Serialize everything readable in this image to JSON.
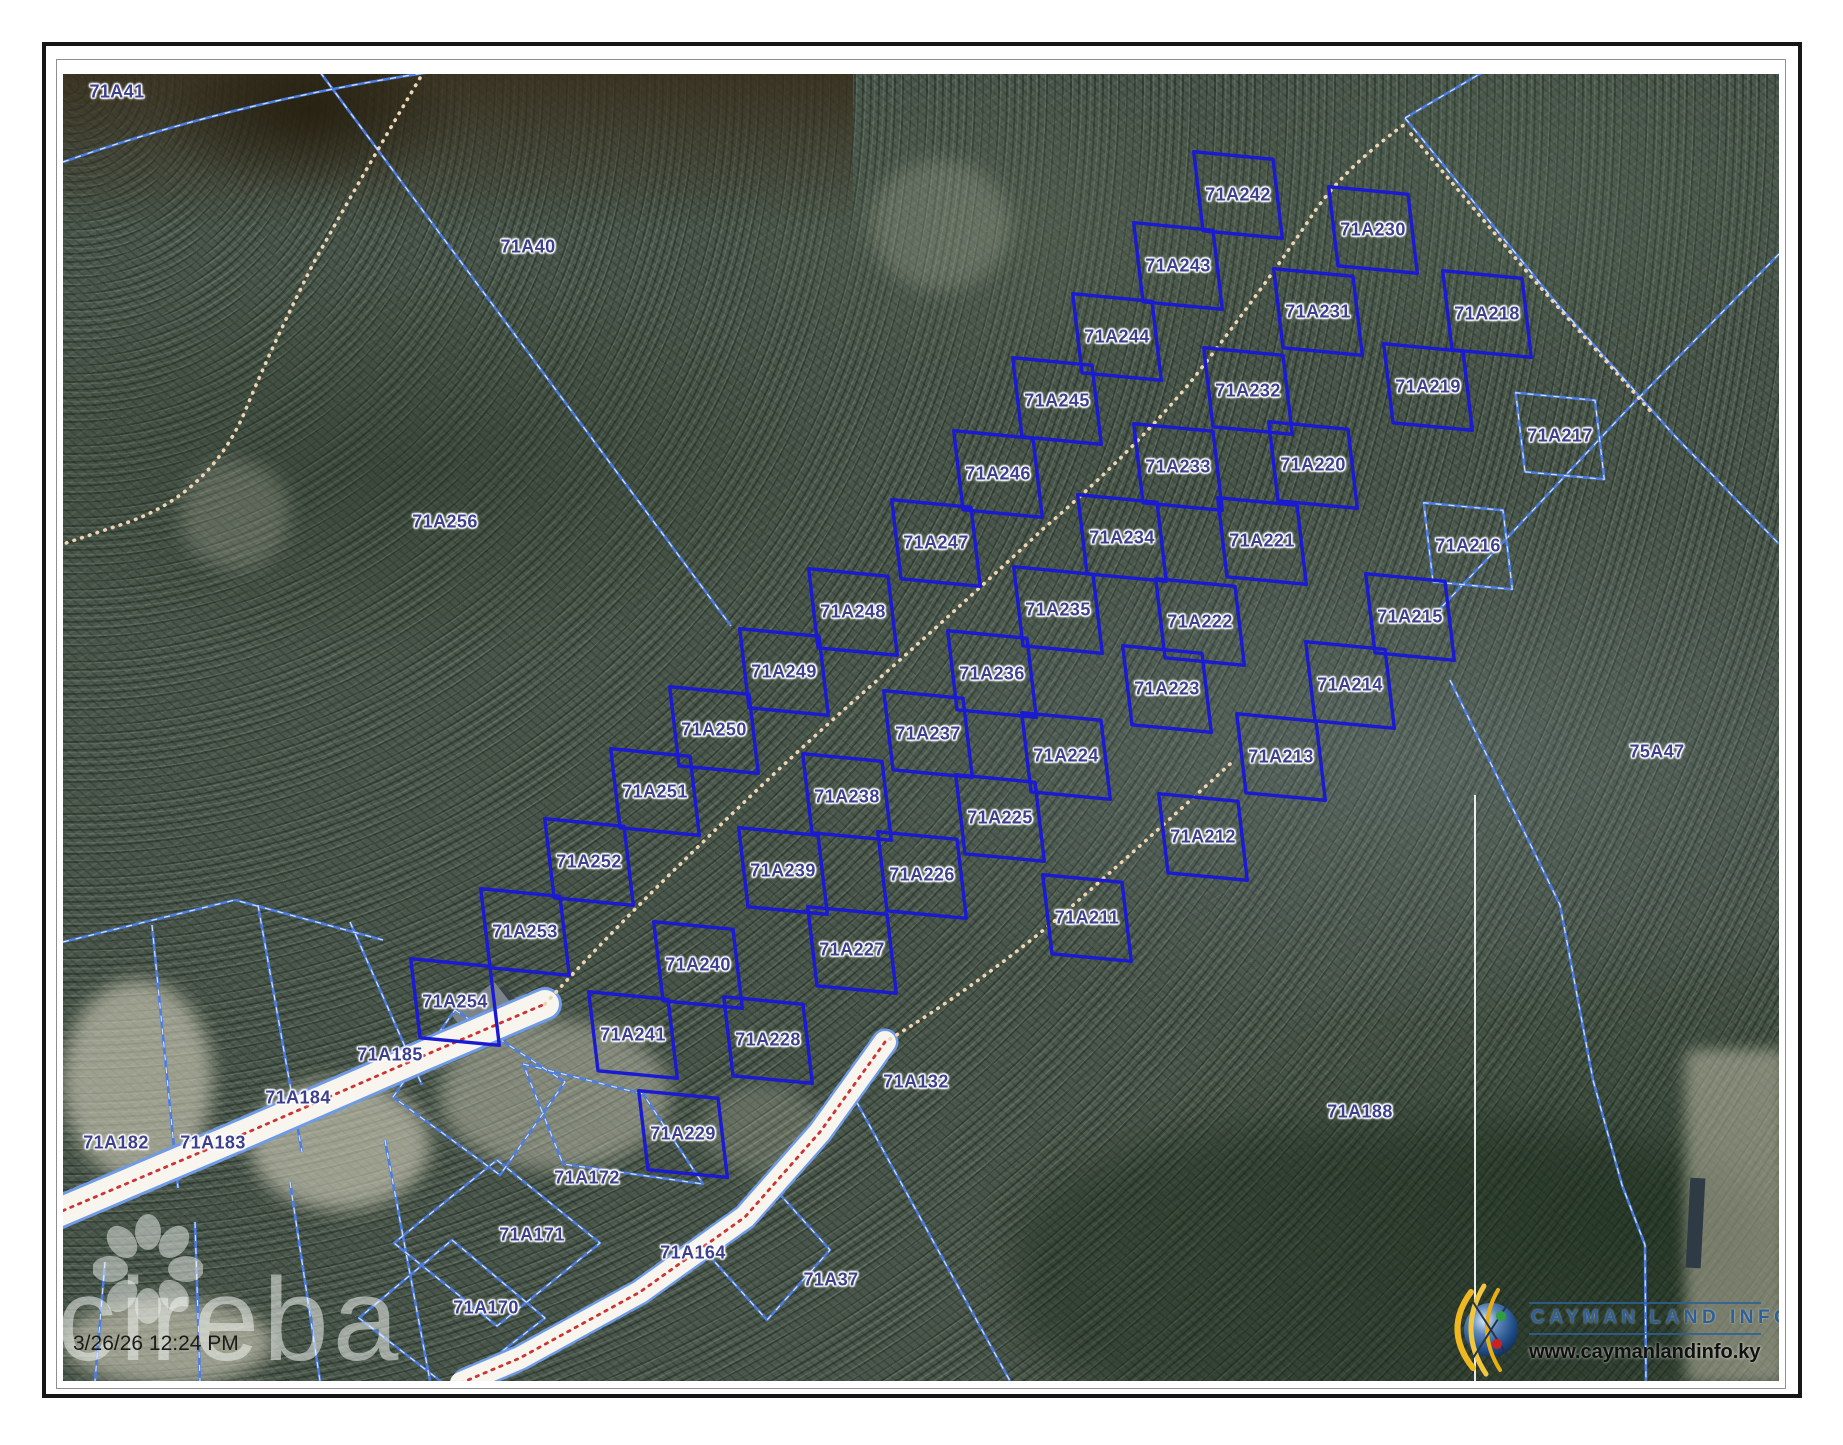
{
  "map": {
    "timestamp": "3/26/26 12:24 PM",
    "watermark": "cireba",
    "logo": {
      "title": "CAYMAN LAND INFO",
      "url": "www.caymanlandinfo.ky"
    },
    "colors": {
      "bold_parcel_line": "#1a1ad2",
      "light_parcel_line": "#4d7de2",
      "label_text": "#3c3e8e",
      "road_centerline": "#cc3333",
      "trail_dots": "#eed4b2"
    },
    "subdivision_parcels": [
      {
        "id": "71A242",
        "x": 1175,
        "y": 121
      },
      {
        "id": "71A243",
        "x": 1115,
        "y": 192
      },
      {
        "id": "71A244",
        "x": 1054,
        "y": 263
      },
      {
        "id": "71A245",
        "x": 994,
        "y": 327
      },
      {
        "id": "71A246",
        "x": 935,
        "y": 400
      },
      {
        "id": "71A247",
        "x": 873,
        "y": 469
      },
      {
        "id": "71A248",
        "x": 790,
        "y": 538
      },
      {
        "id": "71A249",
        "x": 721,
        "y": 598
      },
      {
        "id": "71A250",
        "x": 651,
        "y": 656
      },
      {
        "id": "71A251",
        "x": 592,
        "y": 718
      },
      {
        "id": "71A252",
        "x": 526,
        "y": 788
      },
      {
        "id": "71A253",
        "x": 462,
        "y": 858
      },
      {
        "id": "71A254",
        "x": 392,
        "y": 928
      },
      {
        "id": "71A230",
        "x": 1310,
        "y": 156
      },
      {
        "id": "71A231",
        "x": 1255,
        "y": 238
      },
      {
        "id": "71A232",
        "x": 1185,
        "y": 317
      },
      {
        "id": "71A233",
        "x": 1115,
        "y": 393
      },
      {
        "id": "71A234",
        "x": 1059,
        "y": 464
      },
      {
        "id": "71A235",
        "x": 995,
        "y": 536
      },
      {
        "id": "71A236",
        "x": 929,
        "y": 600
      },
      {
        "id": "71A237",
        "x": 865,
        "y": 660
      },
      {
        "id": "71A238",
        "x": 784,
        "y": 723
      },
      {
        "id": "71A239",
        "x": 720,
        "y": 797
      },
      {
        "id": "71A240",
        "x": 635,
        "y": 891
      },
      {
        "id": "71A241",
        "x": 570,
        "y": 961
      },
      {
        "id": "71A218",
        "x": 1424,
        "y": 240
      },
      {
        "id": "71A219",
        "x": 1365,
        "y": 313
      },
      {
        "id": "71A220",
        "x": 1250,
        "y": 391
      },
      {
        "id": "71A221",
        "x": 1199,
        "y": 467
      },
      {
        "id": "71A222",
        "x": 1137,
        "y": 548
      },
      {
        "id": "71A223",
        "x": 1104,
        "y": 615
      },
      {
        "id": "71A224",
        "x": 1003,
        "y": 682
      },
      {
        "id": "71A225",
        "x": 937,
        "y": 744
      },
      {
        "id": "71A226",
        "x": 859,
        "y": 801
      },
      {
        "id": "71A227",
        "x": 789,
        "y": 876
      },
      {
        "id": "71A228",
        "x": 705,
        "y": 966
      },
      {
        "id": "71A229",
        "x": 620,
        "y": 1060
      },
      {
        "id": "71A215",
        "x": 1347,
        "y": 543
      },
      {
        "id": "71A214",
        "x": 1287,
        "y": 611
      },
      {
        "id": "71A213",
        "x": 1218,
        "y": 683
      },
      {
        "id": "71A212",
        "x": 1140,
        "y": 763
      },
      {
        "id": "71A211",
        "x": 1024,
        "y": 844
      }
    ],
    "light_diamond_parcels": [
      {
        "id": "71A217",
        "x": 1497,
        "y": 362
      },
      {
        "id": "71A216",
        "x": 1405,
        "y": 472
      }
    ],
    "area_labels": [
      {
        "id": "71A41",
        "x": 54,
        "y": 18
      },
      {
        "id": "71A40",
        "x": 465,
        "y": 173
      },
      {
        "id": "71A256",
        "x": 382,
        "y": 448
      },
      {
        "id": "75A47",
        "x": 1594,
        "y": 678
      },
      {
        "id": "71A185",
        "x": 327,
        "y": 981
      },
      {
        "id": "71A184",
        "x": 235,
        "y": 1024
      },
      {
        "id": "71A183",
        "x": 150,
        "y": 1069
      },
      {
        "id": "71A182",
        "x": 53,
        "y": 1069
      },
      {
        "id": "71A172",
        "x": 524,
        "y": 1104
      },
      {
        "id": "71A171",
        "x": 469,
        "y": 1161
      },
      {
        "id": "71A170",
        "x": 423,
        "y": 1234
      },
      {
        "id": "71A164",
        "x": 630,
        "y": 1179
      },
      {
        "id": "71A132",
        "x": 853,
        "y": 1008
      },
      {
        "id": "71A37",
        "x": 768,
        "y": 1206
      },
      {
        "id": "71A188",
        "x": 1297,
        "y": 1038
      }
    ]
  }
}
